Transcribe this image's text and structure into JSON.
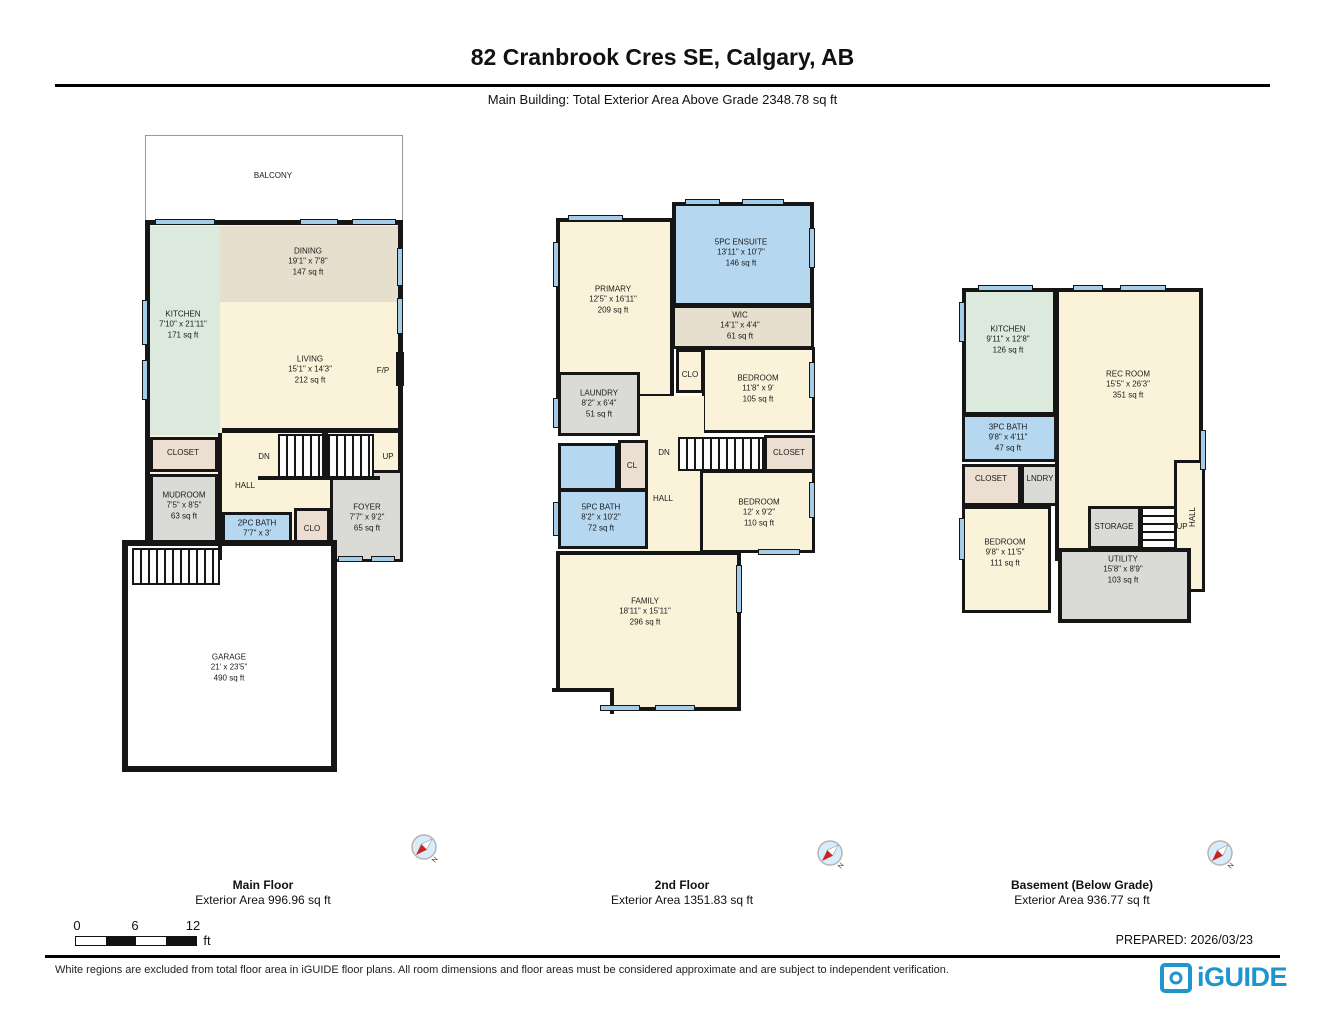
{
  "header": {
    "title": "82 Cranbrook Cres SE, Calgary, AB",
    "subtitle": "Main Building: Total Exterior Area Above Grade 2348.78 sq ft"
  },
  "compass_n": "N",
  "floors": [
    {
      "name": "Main Floor",
      "area_label": "Exterior Area 996.96 sq ft",
      "rooms": [
        {
          "label": "BALCONY",
          "dims": "",
          "area": ""
        },
        {
          "label": "KITCHEN",
          "dims": "7'10\" x 21'11\"",
          "area": "171 sq ft"
        },
        {
          "label": "DINING",
          "dims": "19'1\" x 7'8\"",
          "area": "147 sq ft"
        },
        {
          "label": "LIVING",
          "dims": "15'1\" x 14'3\"",
          "area": "212 sq ft"
        },
        {
          "label": "F/P",
          "dims": "",
          "area": ""
        },
        {
          "label": "CLOSET",
          "dims": "",
          "area": ""
        },
        {
          "label": "MUDROOM",
          "dims": "7'5\" x 8'5\"",
          "area": "63 sq ft"
        },
        {
          "label": "HALL",
          "dims": "",
          "area": ""
        },
        {
          "label": "DN",
          "dims": "",
          "area": ""
        },
        {
          "label": "UP",
          "dims": "",
          "area": ""
        },
        {
          "label": "2PC BATH",
          "dims": "7'7\" x 3'",
          "area": ""
        },
        {
          "label": "CLO",
          "dims": "",
          "area": ""
        },
        {
          "label": "FOYER",
          "dims": "7'7\" x 9'2\"",
          "area": "65 sq ft"
        },
        {
          "label": "GARAGE",
          "dims": "21' x 23'5\"",
          "area": "490 sq ft"
        }
      ]
    },
    {
      "name": "2nd Floor",
      "area_label": "Exterior Area 1351.83 sq ft",
      "rooms": [
        {
          "label": "PRIMARY",
          "dims": "12'5\" x 16'11\"",
          "area": "209 sq ft"
        },
        {
          "label": "5PC ENSUITE",
          "dims": "13'11\" x 10'7\"",
          "area": "146 sq ft"
        },
        {
          "label": "WIC",
          "dims": "14'1\" x 4'4\"",
          "area": "61 sq ft"
        },
        {
          "label": "CLO",
          "dims": "",
          "area": ""
        },
        {
          "label": "BEDROOM",
          "dims": "11'8\" x 9'",
          "area": "105 sq ft"
        },
        {
          "label": "LAUNDRY",
          "dims": "8'2\" x 6'4\"",
          "area": "51 sq ft"
        },
        {
          "label": "CL",
          "dims": "",
          "area": ""
        },
        {
          "label": "DN",
          "dims": "",
          "area": ""
        },
        {
          "label": "CLOSET",
          "dims": "",
          "area": ""
        },
        {
          "label": "HALL",
          "dims": "",
          "area": ""
        },
        {
          "label": "5PC BATH",
          "dims": "8'2\" x 10'2\"",
          "area": "72 sq ft"
        },
        {
          "label": "BEDROOM",
          "dims": "12' x 9'2\"",
          "area": "110 sq ft"
        },
        {
          "label": "FAMILY",
          "dims": "18'11\" x 15'11\"",
          "area": "296 sq ft"
        }
      ]
    },
    {
      "name": "Basement (Below Grade)",
      "area_label": "Exterior Area 936.77 sq ft",
      "rooms": [
        {
          "label": "KITCHEN",
          "dims": "9'11\" x 12'8\"",
          "area": "126 sq ft"
        },
        {
          "label": "REC ROOM",
          "dims": "15'5\" x 26'3\"",
          "area": "351 sq ft"
        },
        {
          "label": "3PC BATH",
          "dims": "9'8\" x 4'11\"",
          "area": "47 sq ft"
        },
        {
          "label": "CLOSET",
          "dims": "",
          "area": ""
        },
        {
          "label": "LNDRY",
          "dims": "",
          "area": ""
        },
        {
          "label": "BEDROOM",
          "dims": "9'8\" x 11'5\"",
          "area": "111 sq ft"
        },
        {
          "label": "STORAGE",
          "dims": "",
          "area": ""
        },
        {
          "label": "UP",
          "dims": "",
          "area": ""
        },
        {
          "label": "HALL",
          "dims": "",
          "area": ""
        },
        {
          "label": "UTILITY",
          "dims": "15'8\" x 8'9\"",
          "area": "103 sq ft"
        }
      ]
    }
  ],
  "scale_bar": {
    "tick0": "0",
    "tick1": "6",
    "tick2": "12",
    "unit": "ft"
  },
  "footer": {
    "prepared": "PREPARED: 2026/03/23",
    "disclaimer": "White regions are excluded from total floor area in iGUIDE floor plans. All room dimensions and floor areas must be considered approximate and are subject to independent verification.",
    "logo_text": "iGUIDE"
  },
  "colors": {
    "wall": "#161616",
    "room_cream": "#faf3da",
    "room_tan": "#e6dfce",
    "room_mint": "#dceade",
    "room_blue": "#b5d8f0",
    "room_gray": "#dadad7",
    "window_blue": "#a5cde9",
    "logo_blue": "#1e95cd"
  }
}
